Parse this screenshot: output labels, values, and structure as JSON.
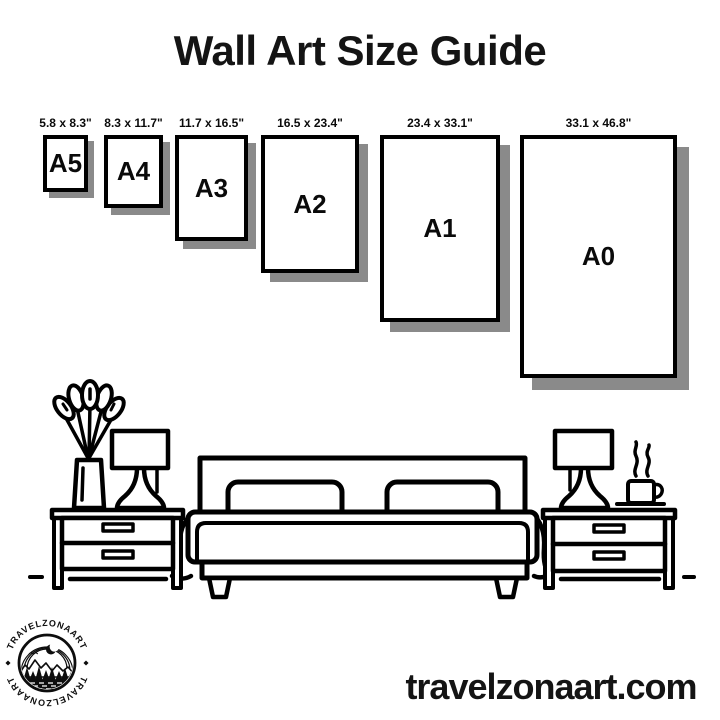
{
  "title": "Wall Art Size Guide",
  "size_guide": {
    "frames": [
      {
        "code": "A5",
        "dimensions": "5.8 x 8.3\""
      },
      {
        "code": "A4",
        "dimensions": "8.3 x 11.7\""
      },
      {
        "code": "A3",
        "dimensions": "11.7 x 16.5\""
      },
      {
        "code": "A2",
        "dimensions": "16.5 x 23.4\""
      },
      {
        "code": "A1",
        "dimensions": "23.4 x 33.1\""
      },
      {
        "code": "A0",
        "dimensions": "33.1 x 46.8\""
      }
    ]
  },
  "logo": {
    "arc_text_top": "TRAVELZONAART",
    "arc_text_bottom": "TRAVELZONAART"
  },
  "footer": {
    "website": "travelzonaart.com"
  },
  "colors": {
    "background": "#ffffff",
    "ink": "#000000",
    "frame_shadow": "#8a8a8a"
  },
  "illustration": {
    "scene": "bedroom with double bed, two nightstands, two lamps, flower vase and coffee cup"
  }
}
